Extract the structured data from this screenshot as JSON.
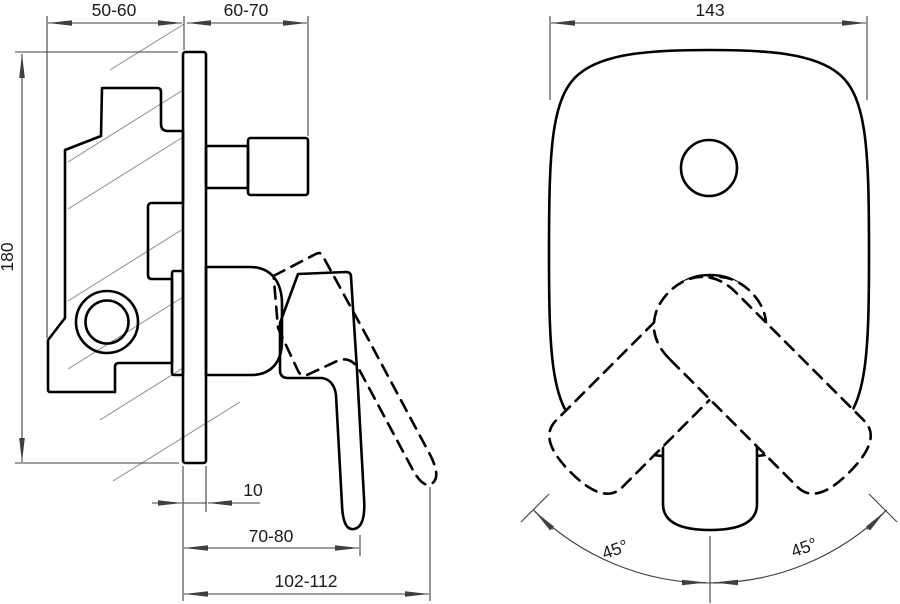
{
  "drawing_type": "technical-dimension-drawing",
  "subject": "concealed-shower-mixer-two-views",
  "side_view": {
    "dim_embed_depth": "50-60",
    "dim_protrusion": "60-70",
    "dim_height": "180",
    "dim_plate_thickness": "10",
    "dim_lever_reach": "70-80",
    "dim_total_reach": "102-112"
  },
  "front_view": {
    "dim_width": "143",
    "dim_swing_left": "45°",
    "dim_swing_right": "45°"
  },
  "colors": {
    "outline": "#000000",
    "dimension": "#3f3f3f",
    "dashed": "#989898",
    "hatch": "#8a8a8a",
    "text": "#1a1a1a",
    "background": "#ffffff"
  }
}
